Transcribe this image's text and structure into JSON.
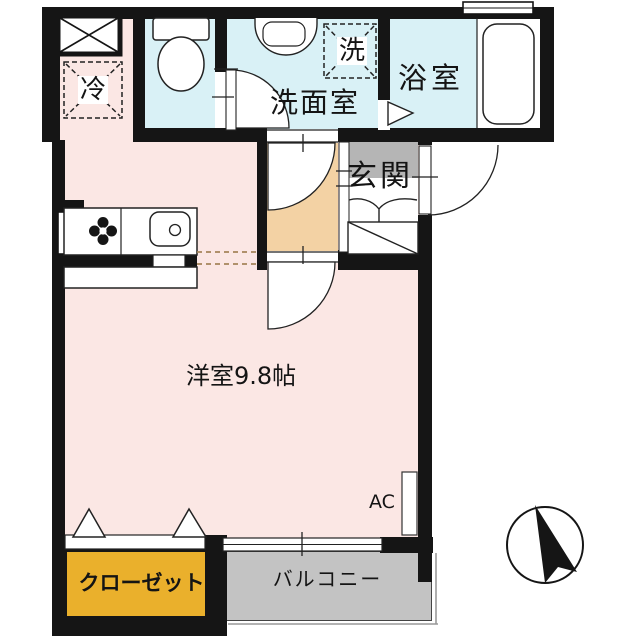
{
  "plan": {
    "type": "japanese-apartment-floor-plan",
    "labels": {
      "living": "洋室9.8帖",
      "washroom": "洗面室",
      "bathroom": "浴室",
      "entrance": "玄関",
      "closet": "クローゼット",
      "balcony": "バルコニー",
      "fridge": "冷",
      "laundry": "洗",
      "ac": "AC"
    },
    "icons": [
      "toilet-icon",
      "washbasin-icon",
      "bathtub-icon",
      "stove-icon",
      "kitchen-sink-icon",
      "shaft-x-box-icon",
      "fridge-dashed-box-icon",
      "laundry-dashed-box-icon",
      "door-swing-arc",
      "folding-door-triangle-icon",
      "shoe-cabinet-icon",
      "window-icon",
      "compass-north-arrow-icon"
    ],
    "colors": {
      "wall": "#151515",
      "floor_living": "#fbe7e4",
      "floor_wet_area": "#d9f1f6",
      "floor_corridor": "#f3d2a4",
      "floor_entrance": "#b5b5b5",
      "floor_balcony": "#c3c3c3",
      "closet_fill": "#eab02c",
      "kitchen_dash_line": "#a5855a"
    }
  }
}
